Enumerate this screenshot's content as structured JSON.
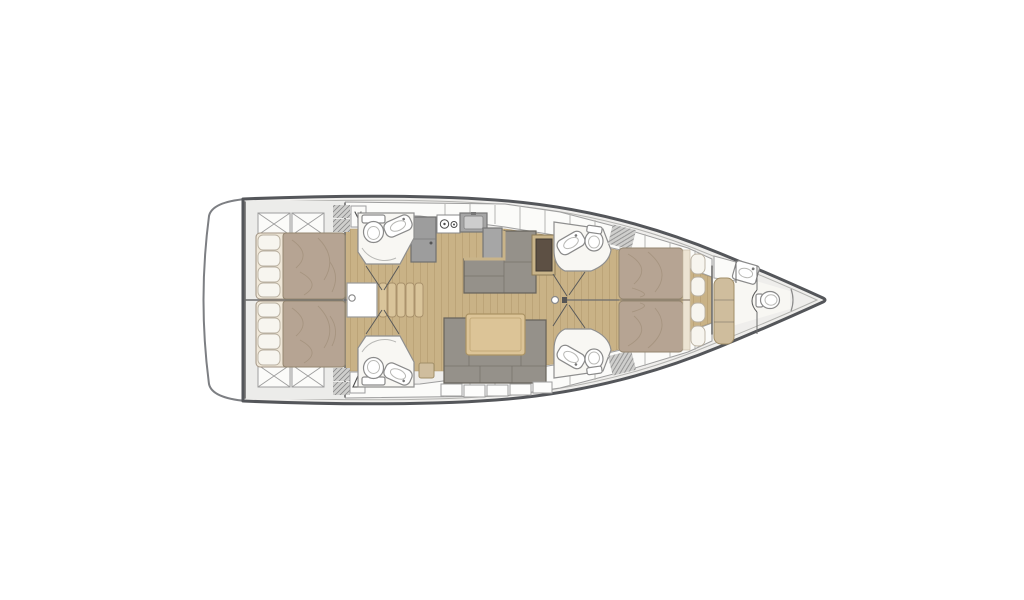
{
  "diagram": {
    "kind": "sailing-yacht-interior-floorplan",
    "orientation": "bow-right",
    "areas": [
      "swim-platform-transom",
      "aft-deck-lockers",
      "aft-cabin-port",
      "aft-cabin-starboard",
      "aft-head-port",
      "aft-head-starboard",
      "companionway-stairs",
      "galley",
      "chart-table-dinette",
      "salon-sofa-and-table",
      "forward-head-port",
      "forward-head-starboard",
      "owner-cabin",
      "bow-cabin-with-head",
      "anchor-locker"
    ]
  },
  "colors": {
    "background": "#ffffff",
    "hull_stroke": "#54565a",
    "hull_inner": "#b3b3b0",
    "deck": "#efeeec",
    "transom": "#ffffff",
    "cabin_floor": "#ececea",
    "wood": "#c9b286",
    "plank": "#b1996d",
    "locker": "#fbfbf9",
    "locker_stroke": "#9e9e9e",
    "tick": "#b5b5b2",
    "bed_duvet": "#b6a493",
    "bed_duvet_stroke": "#94866f",
    "bed_sheet": "#efe7d8",
    "pillow": "#f7f5ef",
    "pillow_stroke": "#b9b0a0",
    "wrinkle": "#a3927d",
    "sofa": "#95918a",
    "sofa_stroke": "#68645c",
    "table": "#dcc497",
    "table_stroke": "#ab9364",
    "wood_trim": "#c9b489",
    "chart_dark": "#5d5044",
    "chart_stroke": "#3e3931",
    "counter": "#a6a6a6",
    "counter_stroke": "#767676",
    "appliance": "#9d9d9d",
    "head_floor": "#f8f7f3",
    "room_stroke": "#8f8f8f",
    "fixture": "#ffffff",
    "fixture_stroke": "#8a8a8a",
    "fixture_inner": "#b9b9b6",
    "hatch": "#cfcfcd",
    "hatch_stroke": "#707070",
    "bench": "#cfbd9d",
    "bench_stroke": "#a18e68",
    "stairs": "#d9c49a",
    "wall": "#6d6d6d",
    "door": "#5a5a5a",
    "glyph": "#4c4c4c"
  }
}
